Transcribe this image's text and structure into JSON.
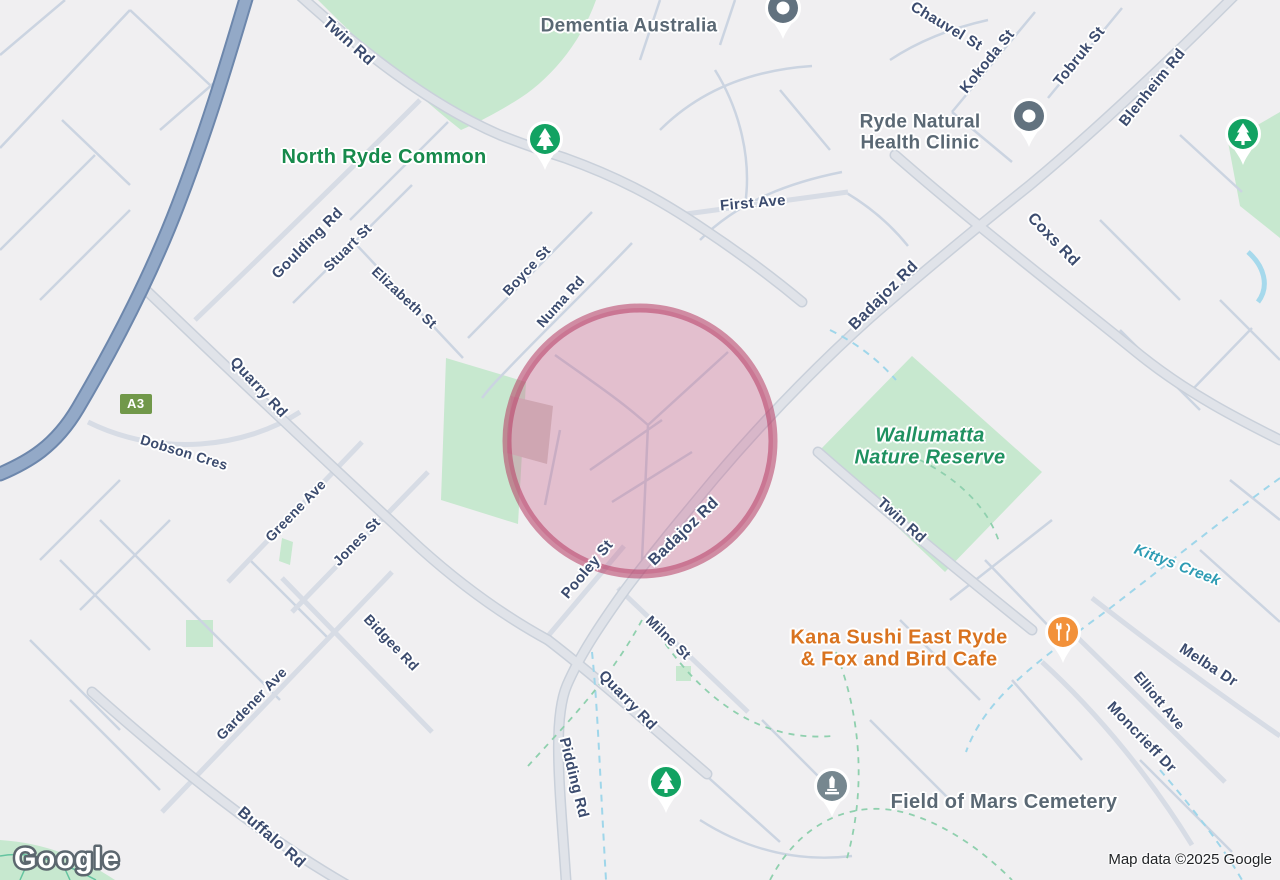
{
  "map": {
    "attribution": "Map data ©2025 Google",
    "logo_text": "Google",
    "route_badge": {
      "label": "A3",
      "x": 120,
      "y": 394,
      "color": "#71984a"
    }
  },
  "highlight_overlay": {
    "shape": "circle",
    "cx": 640,
    "cy": 441,
    "r": 133,
    "fill": "rgba(199,90,133,0.32)",
    "stroke": "rgba(183,58,99,0.55)",
    "stroke_width": 9
  },
  "colors": {
    "background": "#f0eff1",
    "park": "#c7e8cf",
    "road_minor": "#cbd4e1",
    "road_medium": "#d7dce5",
    "road_arterial": "#dde1e8",
    "highway": "#93a9c7",
    "creek": "#9fd6ea",
    "trail": "#8fd0ae",
    "street_label": "#3b4b6e",
    "park_label": "#178a4c",
    "poi_label": "#5a6874",
    "restaurant_label": "#d9731f",
    "water_label": "#2e9cb4"
  },
  "labels": [
    {
      "type": "road",
      "lines": [
        "Twin Rd"
      ],
      "x": 348,
      "y": 42,
      "rot": 42,
      "size": 16
    },
    {
      "type": "road",
      "lines": [
        "Chauvel St"
      ],
      "x": 946,
      "y": 27,
      "rot": 31,
      "size": 15
    },
    {
      "type": "road",
      "lines": [
        "Kokoda St"
      ],
      "x": 988,
      "y": 62,
      "rot": -51,
      "size": 15
    },
    {
      "type": "road",
      "lines": [
        "Tobruk St"
      ],
      "x": 1080,
      "y": 57,
      "rot": -51,
      "size": 15
    },
    {
      "type": "road",
      "lines": [
        "Blenheim Rd"
      ],
      "x": 1153,
      "y": 88,
      "rot": -51,
      "size": 15
    },
    {
      "type": "road",
      "lines": [
        "First Ave"
      ],
      "x": 753,
      "y": 204,
      "rot": -5,
      "size": 15
    },
    {
      "type": "road",
      "lines": [
        "Coxs Rd"
      ],
      "x": 1053,
      "y": 240,
      "rot": 46,
      "size": 16
    },
    {
      "type": "road",
      "lines": [
        "Badajoz Rd"
      ],
      "x": 884,
      "y": 296,
      "rot": -45,
      "size": 16
    },
    {
      "type": "road",
      "lines": [
        "Goulding Rd"
      ],
      "x": 308,
      "y": 244,
      "rot": -45,
      "size": 15
    },
    {
      "type": "road",
      "lines": [
        "Stuart St"
      ],
      "x": 348,
      "y": 248,
      "rot": -45,
      "size": 14
    },
    {
      "type": "road",
      "lines": [
        "Elizabeth St"
      ],
      "x": 404,
      "y": 298,
      "rot": 43,
      "size": 14
    },
    {
      "type": "road",
      "lines": [
        "Boyce St"
      ],
      "x": 527,
      "y": 271,
      "rot": -47,
      "size": 14
    },
    {
      "type": "road",
      "lines": [
        "Numa Rd"
      ],
      "x": 561,
      "y": 302,
      "rot": -48,
      "size": 14
    },
    {
      "type": "road",
      "lines": [
        "Quarry Rd"
      ],
      "x": 258,
      "y": 388,
      "rot": 47,
      "size": 15
    },
    {
      "type": "road",
      "lines": [
        "Dobson Cres"
      ],
      "x": 184,
      "y": 453,
      "rot": 17,
      "size": 14
    },
    {
      "type": "road",
      "lines": [
        "Greene Ave"
      ],
      "x": 296,
      "y": 511,
      "rot": -46,
      "size": 14
    },
    {
      "type": "road",
      "lines": [
        "Jones St"
      ],
      "x": 357,
      "y": 542,
      "rot": -46,
      "size": 14
    },
    {
      "type": "road",
      "lines": [
        "Pooley St"
      ],
      "x": 588,
      "y": 570,
      "rot": -50,
      "size": 15
    },
    {
      "type": "road",
      "lines": [
        "Badajoz Rd"
      ],
      "x": 684,
      "y": 532,
      "rot": -44,
      "size": 16
    },
    {
      "type": "road",
      "lines": [
        "Twin Rd"
      ],
      "x": 901,
      "y": 521,
      "rot": 42,
      "size": 15
    },
    {
      "type": "road",
      "lines": [
        "Milne St"
      ],
      "x": 668,
      "y": 638,
      "rot": 44,
      "size": 14
    },
    {
      "type": "road",
      "lines": [
        "Bidgee Rd"
      ],
      "x": 391,
      "y": 643,
      "rot": 46,
      "size": 14
    },
    {
      "type": "road",
      "lines": [
        "Gardener Ave"
      ],
      "x": 252,
      "y": 704,
      "rot": -46,
      "size": 14
    },
    {
      "type": "road",
      "lines": [
        "Melba Dr"
      ],
      "x": 1208,
      "y": 666,
      "rot": 33,
      "size": 15
    },
    {
      "type": "road",
      "lines": [
        "Elliott Ave"
      ],
      "x": 1159,
      "y": 701,
      "rot": 50,
      "size": 14
    },
    {
      "type": "road",
      "lines": [
        "Moncrieff Dr"
      ],
      "x": 1141,
      "y": 738,
      "rot": 46,
      "size": 15
    },
    {
      "type": "road",
      "lines": [
        "Quarry Rd"
      ],
      "x": 627,
      "y": 701,
      "rot": 46,
      "size": 15
    },
    {
      "type": "road",
      "lines": [
        "Pidding Rd"
      ],
      "x": 573,
      "y": 778,
      "rot": 76,
      "size": 15
    },
    {
      "type": "road",
      "lines": [
        "Buffalo Rd"
      ],
      "x": 271,
      "y": 838,
      "rot": 41,
      "size": 16
    },
    {
      "type": "park",
      "lines": [
        "North Ryde Common"
      ],
      "x": 384,
      "y": 157,
      "rot": 0,
      "size": 20
    },
    {
      "type": "park-italic",
      "lines": [
        "Wallumatta",
        "Nature Reserve"
      ],
      "x": 930,
      "y": 447,
      "rot": 0,
      "size": 20
    },
    {
      "type": "water",
      "lines": [
        "Kittys Creek"
      ],
      "x": 1177,
      "y": 566,
      "rot": 21,
      "size": 15
    },
    {
      "type": "poi",
      "lines": [
        "Dementia Australia"
      ],
      "x": 629,
      "y": 26,
      "rot": 0,
      "size": 19
    },
    {
      "type": "poi",
      "lines": [
        "Ryde Natural",
        "Health Clinic"
      ],
      "x": 920,
      "y": 133,
      "rot": 0,
      "size": 19
    },
    {
      "type": "restaurant",
      "lines": [
        "Kana Sushi East Ryde",
        "& Fox and Bird Cafe"
      ],
      "x": 899,
      "y": 649,
      "rot": 0,
      "size": 20
    },
    {
      "type": "poi",
      "lines": [
        "Field of Mars Cemetery"
      ],
      "x": 1004,
      "y": 802,
      "rot": 0,
      "size": 20
    }
  ],
  "markers": [
    {
      "type": "poi-pin",
      "name": "dementia-australia-pin",
      "x": 783,
      "y": 22
    },
    {
      "type": "poi-pin",
      "name": "ryde-natural-health-clinic-pin",
      "x": 1029,
      "y": 130
    },
    {
      "type": "park-pin",
      "name": "north-ryde-common-pin",
      "x": 545,
      "y": 153
    },
    {
      "type": "park-pin",
      "name": "park-pin-northeast",
      "x": 1243,
      "y": 148
    },
    {
      "type": "park-pin",
      "name": "park-pin-south",
      "x": 666,
      "y": 796
    },
    {
      "type": "restaurant-pin",
      "name": "kana-sushi-pin",
      "x": 1063,
      "y": 646
    },
    {
      "type": "cemetery-pin",
      "name": "field-of-mars-cemetery-pin",
      "x": 832,
      "y": 800
    }
  ]
}
